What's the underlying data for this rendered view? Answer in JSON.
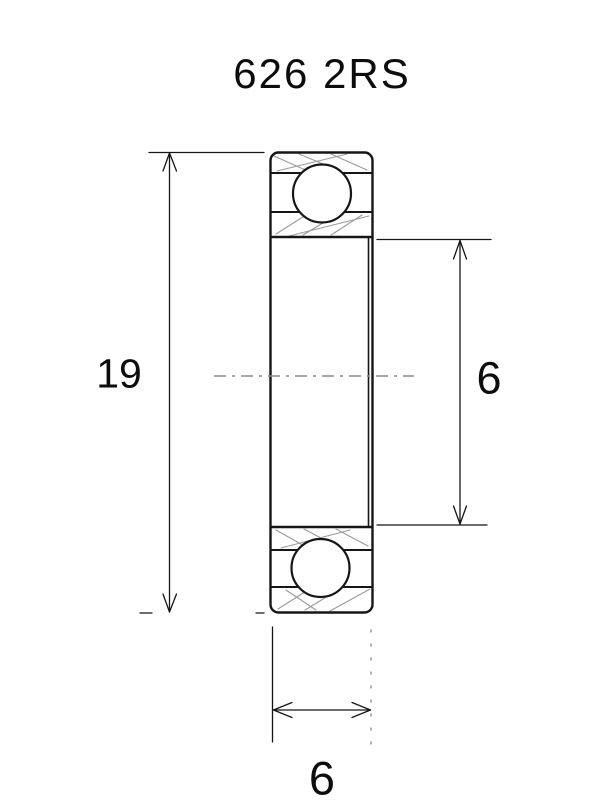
{
  "title": "626 2RS",
  "dimensions": {
    "outer_diameter": {
      "value": "19",
      "position": "left",
      "orientation": "vertical"
    },
    "bore_diameter": {
      "value": "6",
      "position": "right",
      "orientation": "vertical"
    },
    "width": {
      "value": "6",
      "position": "bottom",
      "orientation": "horizontal"
    }
  },
  "colors": {
    "line": "#161616",
    "hatch": "#9b9b9b",
    "centerline": "#8a8a8a",
    "background": "#ffffff"
  }
}
